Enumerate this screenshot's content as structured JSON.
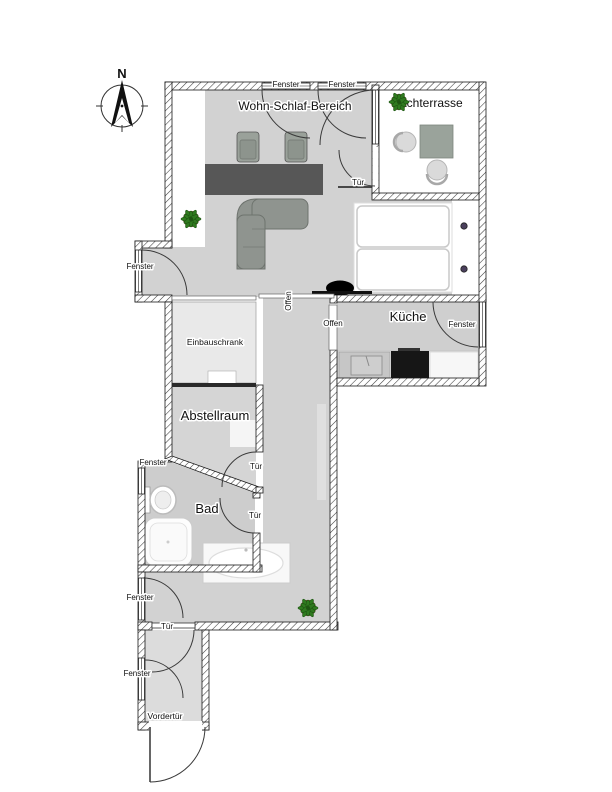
{
  "compass": {
    "north": "N"
  },
  "rooms": {
    "living_sleeping": "Wohn-Schlaf-Bereich",
    "roof_terrace": "Dachterrasse",
    "kitchen": "Küche",
    "built_in_wardrobe": "Einbauschrank",
    "storage": "Abstellraum",
    "bathroom": "Bad"
  },
  "openings": {
    "window": "Fenster",
    "door": "Tür",
    "open": "Offen",
    "front_door": "Vordertür"
  },
  "colors": {
    "floor_gray": "#d2d2d2",
    "floor_wardrobe": "#e9e9e9",
    "floor_storage": "#d5d5d5",
    "floor_bath": "#cdcdcd",
    "floor_entry": "#dcdcdc",
    "wall_line": "#1a1a1a",
    "desk_dark": "#575757",
    "furniture_green_gray": "#8f948f",
    "stove_black": "#161616",
    "plant_green": "#2f7a1f",
    "plant_pot": "#8a5a2a"
  },
  "icons": [
    "compass-rose",
    "plant",
    "desk",
    "desk-chair",
    "corner-sofa",
    "double-bed",
    "bed-lamp",
    "tv",
    "terrace-table",
    "terrace-chair",
    "kitchen-sink",
    "stove",
    "countertop",
    "toilet",
    "shower",
    "bathtub",
    "window-symbol",
    "door-swing-arc",
    "open-passage-marker"
  ]
}
